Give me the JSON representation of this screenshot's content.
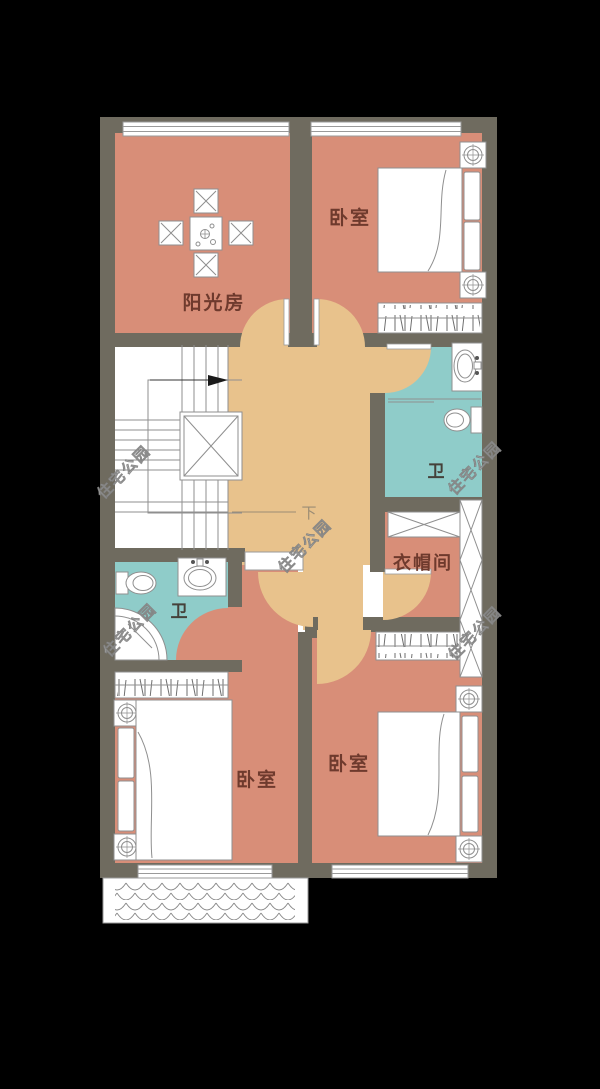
{
  "watermark": "住宅公园",
  "rooms": {
    "sunroom": "阳光房",
    "bedroom_top_right": "卧室",
    "bedroom_bottom_left": "卧室",
    "bedroom_bottom_right": "卧室",
    "bath_right": "卫",
    "bath_left": "卫",
    "closet": "衣帽间"
  },
  "stairs": {
    "down_label": "下"
  },
  "colors": {
    "background": "#000000",
    "wall": "#6f6b5f",
    "room_fill": "#d88e78",
    "hall_fill": "#e8c28c",
    "bath_fill": "#8fccc9",
    "line": "#8f8f8f",
    "label": "#6e3a2d"
  }
}
